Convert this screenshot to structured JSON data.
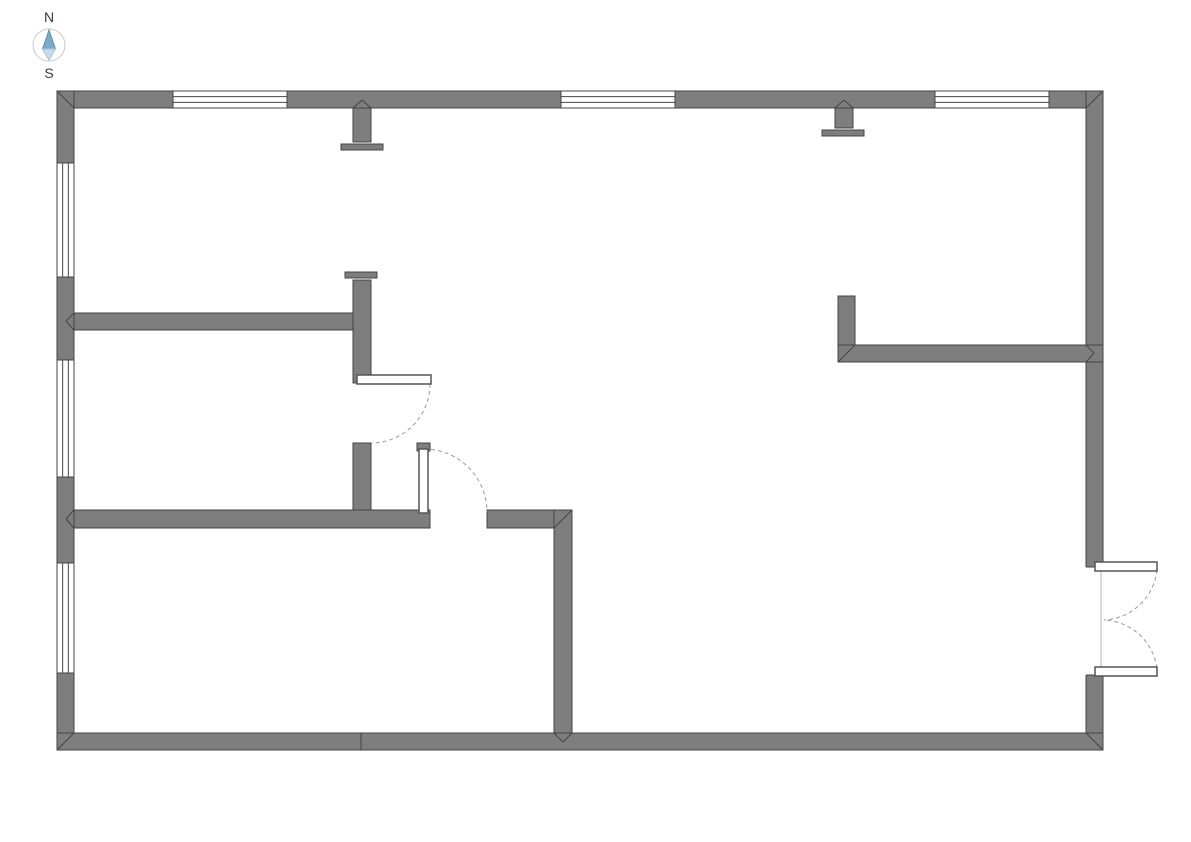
{
  "meta": {
    "width": 1191,
    "height": 842,
    "background": "#ffffff"
  },
  "compass": {
    "north_label": "N",
    "south_label": "S",
    "cx": 49,
    "cy": 45,
    "r": 16,
    "circle_color": "#c9c9c9",
    "needle_north_points": "49,30 42.5,49 55.5,49",
    "needle_south_points": "42.5,49 55.5,49 49,60",
    "north_color": "#7cabc9",
    "south_color": "#c6dae8",
    "north_stroke": "#5b8fae",
    "south_stroke": "#a9c4d6",
    "label_color": "#3a3a3a",
    "label_font_size": 14
  },
  "floorplan": {
    "colors": {
      "wall_fill": "#7e7e7e",
      "wall_stroke": "#444444",
      "window_fill": "#ffffff",
      "window_line": "#444444",
      "opening_fill": "#ffffff",
      "opening_faint_line": "#b5b5b5",
      "door_leaf_fill": "#ffffff",
      "door_leaf_stroke": "#555555",
      "arc_color": "#9a9a9a"
    },
    "walls": [
      {
        "name": "top-wall",
        "x": 57,
        "y": 91,
        "w": 1046,
        "h": 17
      },
      {
        "name": "left-wall",
        "x": 57,
        "y": 91,
        "w": 17,
        "h": 659
      },
      {
        "name": "right-wall",
        "x": 1086,
        "y": 91,
        "w": 17,
        "h": 659
      },
      {
        "name": "bottom-wall",
        "x": 57,
        "y": 733,
        "w": 1046,
        "h": 17
      },
      {
        "name": "top-wall-stub-a",
        "x": 353,
        "y": 108,
        "w": 18,
        "h": 34
      },
      {
        "name": "top-wall-stub-b",
        "x": 835,
        "y": 108,
        "w": 18,
        "h": 20
      },
      {
        "name": "interior-wall-h1",
        "x": 74,
        "y": 313,
        "w": 288,
        "h": 17
      },
      {
        "name": "interior-wall-v1-upper",
        "x": 353,
        "y": 280,
        "w": 18,
        "h": 103
      },
      {
        "name": "interior-wall-v1-lower",
        "x": 353,
        "y": 443,
        "w": 18,
        "h": 85
      },
      {
        "name": "interior-wall-h2-left",
        "x": 74,
        "y": 510,
        "w": 356,
        "h": 18
      },
      {
        "name": "interior-wall-h2-right",
        "x": 487,
        "y": 510,
        "w": 85,
        "h": 18
      },
      {
        "name": "interior-wall-v2",
        "x": 554,
        "y": 510,
        "w": 18,
        "h": 223
      },
      {
        "name": "interior-wall-stub-v3",
        "x": 838,
        "y": 296,
        "w": 17,
        "h": 66
      },
      {
        "name": "interior-wall-h3",
        "x": 838,
        "y": 345,
        "w": 265,
        "h": 17
      }
    ],
    "endcaps": [
      {
        "name": "stub-a-endcap",
        "x": 341,
        "y": 144,
        "w": 42,
        "h": 6
      },
      {
        "name": "stub-b-endcap",
        "x": 822,
        "y": 130,
        "w": 42,
        "h": 6
      },
      {
        "name": "v1-endcap",
        "x": 345,
        "y": 272,
        "w": 32,
        "h": 6
      },
      {
        "name": "door-2-frame-cap",
        "x": 417,
        "y": 443,
        "w": 13,
        "h": 8
      }
    ],
    "windows": [
      {
        "name": "window-top-1",
        "x": 173,
        "y": 91,
        "w": 114,
        "h": 17,
        "orient": "h"
      },
      {
        "name": "window-top-2",
        "x": 561,
        "y": 91,
        "w": 114,
        "h": 17,
        "orient": "h"
      },
      {
        "name": "window-top-3",
        "x": 935,
        "y": 91,
        "w": 114,
        "h": 17,
        "orient": "h"
      },
      {
        "name": "window-left-1",
        "x": 57,
        "y": 163,
        "w": 17,
        "h": 114,
        "orient": "v"
      },
      {
        "name": "window-left-2",
        "x": 57,
        "y": 360,
        "w": 17,
        "h": 117,
        "orient": "v"
      },
      {
        "name": "window-left-3",
        "x": 57,
        "y": 563,
        "w": 17,
        "h": 110,
        "orient": "v"
      }
    ],
    "openings": [
      {
        "name": "double-door-opening",
        "x": 1086,
        "y": 567,
        "w": 17,
        "h": 108
      }
    ],
    "door_leaves": [
      {
        "name": "door-1-leaf",
        "x": 357,
        "y": 375,
        "w": 74,
        "h": 9
      },
      {
        "name": "door-2-leaf",
        "x": 419,
        "y": 449,
        "w": 9,
        "h": 64
      },
      {
        "name": "double-door-top-leaf",
        "x": 1095,
        "y": 562,
        "w": 62,
        "h": 9
      },
      {
        "name": "double-door-bottom-leaf",
        "x": 1095,
        "y": 667,
        "w": 62,
        "h": 9
      }
    ],
    "door_arcs": [
      {
        "name": "door-1-swing-arc",
        "d": "M 430 384 A 59 59 0 0 1 371 443"
      },
      {
        "name": "door-2-swing-arc",
        "d": "M 424 449 A 63 63 0 0 1 487 512"
      },
      {
        "name": "double-door-top-swing-arc",
        "d": "M 1157 570 A 56 56 0 0 1 1104 620"
      },
      {
        "name": "double-door-bottom-swing-arc",
        "d": "M 1157 668 A 56 56 0 0 0 1104 620"
      }
    ],
    "seams": [
      {
        "x1": 57,
        "y1": 91,
        "x2": 74,
        "y2": 108
      },
      {
        "x1": 1103,
        "y1": 91,
        "x2": 1086,
        "y2": 108
      },
      {
        "x1": 57,
        "y1": 750,
        "x2": 74,
        "y2": 733
      },
      {
        "x1": 1103,
        "y1": 750,
        "x2": 1086,
        "y2": 733
      },
      {
        "x1": 838,
        "y1": 362,
        "x2": 855,
        "y2": 345
      },
      {
        "x1": 572,
        "y1": 510,
        "x2": 554,
        "y2": 528
      },
      {
        "x1": 554,
        "y1": 733,
        "x2": 563,
        "y2": 742
      },
      {
        "x1": 572,
        "y1": 733,
        "x2": 563,
        "y2": 742
      },
      {
        "x1": 353,
        "y1": 108,
        "x2": 362,
        "y2": 100
      },
      {
        "x1": 371,
        "y1": 108,
        "x2": 362,
        "y2": 100
      },
      {
        "x1": 835,
        "y1": 108,
        "x2": 844,
        "y2": 100
      },
      {
        "x1": 853,
        "y1": 108,
        "x2": 844,
        "y2": 100
      },
      {
        "x1": 74,
        "y1": 313,
        "x2": 66,
        "y2": 321
      },
      {
        "x1": 74,
        "y1": 330,
        "x2": 66,
        "y2": 321
      },
      {
        "x1": 74,
        "y1": 510,
        "x2": 66,
        "y2": 519
      },
      {
        "x1": 74,
        "y1": 528,
        "x2": 66,
        "y2": 519
      },
      {
        "x1": 1086,
        "y1": 345,
        "x2": 1094,
        "y2": 353
      },
      {
        "x1": 1086,
        "y1": 362,
        "x2": 1094,
        "y2": 353
      },
      {
        "x1": 361,
        "y1": 733,
        "x2": 361,
        "y2": 750
      }
    ]
  }
}
